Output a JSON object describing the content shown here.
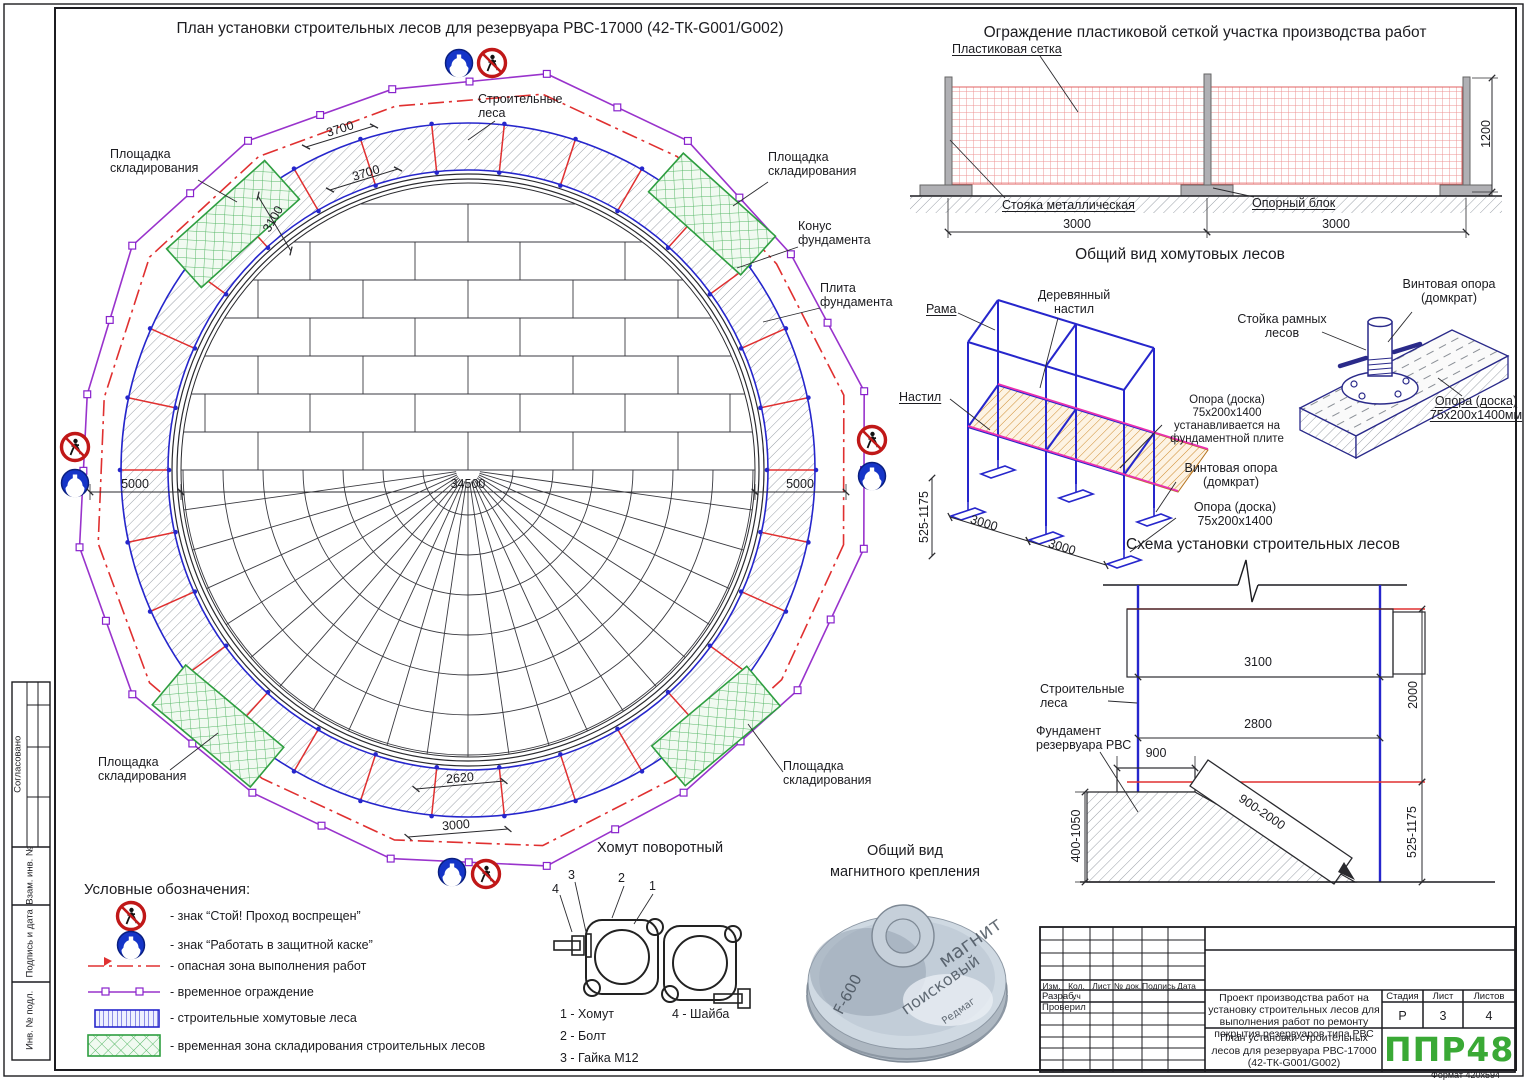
{
  "colors": {
    "accent_blue": "#2626cc",
    "fence_purple": "#9933cc",
    "danger_red": "#e03030",
    "zone_green": "#2e9e40",
    "logo_green": "#3aa935",
    "magenta": "#ea30b0",
    "deck_tan": "#c8862e"
  },
  "plan": {
    "title": "План установки строительных лесов для резервуара РВС-17000 (42-ТК-G001/G002)",
    "scaffolding_label": "Строительные леса",
    "storage_label": "Площадка складирования",
    "cone_label": "Конус фундамента",
    "slab_label": "Плита фундамента",
    "dim_bay_1": "3700",
    "dim_bay_2": "3700",
    "dim_ring_width": "3100",
    "dim_offset_left": "5000",
    "dim_diameter": "34500",
    "dim_offset_right": "5000",
    "dim_arc": "2620",
    "dim_bay_bottom": "3000"
  },
  "fence": {
    "title": "Ограждение пластиковой сеткой участка производства работ",
    "mesh_label": "Пластиковая сетка",
    "post_label": "Стояка металлическая",
    "block_label": "Опорный блок",
    "dim_span_left": "3000",
    "dim_span_right": "3000",
    "dim_height": "1200"
  },
  "scaffold_view": {
    "title": "Общий вид хомутовых лесов",
    "frame_label": "Рама",
    "deck_label": "Деревянный настил",
    "deck2_label": "Настил",
    "support_note": "Опора (доска) 75х200х1400 устанавливается на фундаментной плите",
    "jack_label": "Винтовая опора (домкрат)",
    "support_label": "Опора (доска) 75х200х1400",
    "dim_bay1": "3000",
    "dim_bay2": "3000",
    "dim_height": "525-1175"
  },
  "jack_detail": {
    "jack_label": "Винтовая опора (домкрат)",
    "stand_label": "Стойка рамных лесов",
    "board_label": "Опора (доска) 75х200х1400мм"
  },
  "scheme": {
    "title": "Схема установки строительных лесов",
    "scaffolding_label": "Строительные леса",
    "foundation_label": "Фундамент резервуара РВС",
    "dim_top": "3100",
    "dim_mid": "2800",
    "dim_step": "900",
    "dim_height": "2000",
    "dim_bottom_height": "525-1175",
    "dim_found_height": "400-1050",
    "dim_board": "900-2000"
  },
  "legend": {
    "title": "Условные обозначения:",
    "items": [
      {
        "symbol": "no-entry-sign",
        "text": "- знак “Стой! Проход воспрещен”"
      },
      {
        "symbol": "hardhat-sign",
        "text": "- знак “Работать в защитной каске”"
      },
      {
        "symbol": "danger-line",
        "text": "- опасная зона выполнения работ"
      },
      {
        "symbol": "temp-fence-line",
        "text": "- временное ограждение"
      },
      {
        "symbol": "scaffold-rect",
        "text": "- строительные хомутовые леса"
      },
      {
        "symbol": "storage-rect",
        "text": "- временная зона складирования строительных лесов"
      }
    ]
  },
  "clamp": {
    "title": "Хомут поворотный",
    "callout_1": "1",
    "callout_2": "2",
    "callout_3": "3",
    "callout_4": "4",
    "part_1": "1 - Хомут",
    "part_2": "2 - Болт",
    "part_3": "3 - Гайка М12",
    "part_4": "4 - Шайба"
  },
  "magnet": {
    "title_1": "Общий вид",
    "title_2": "магнитного крепления",
    "inscription_1": "магнит",
    "inscription_2": "поисковый",
    "model": "F-600",
    "brand": "Редмаг"
  },
  "titleblock": {
    "headers": [
      "Изм.",
      "Кол. уч",
      "Лист",
      "№ док.",
      "Подпись",
      "Дата"
    ],
    "row_1": "Разраб.",
    "row_2": "Проверил",
    "project": "Проект производства работ на установку строительных лесов для выполнения работ по ремонту покрытия резервуаров типа РВС",
    "doc_title": "План установки строительных лесов для резервуара РВС-17000 (42-ТК-G001/G002)",
    "stage_header": "Стадия",
    "sheet_header": "Лист",
    "sheets_header": "Листов",
    "stage": "Р",
    "sheet": "3",
    "sheets": "4",
    "logo": "ППР48",
    "format_note": "Формат 420х594"
  },
  "stamps": [
    "Согласовано",
    "Взам. инв. №",
    "Подпись и дата",
    "Инв. № подл."
  ]
}
